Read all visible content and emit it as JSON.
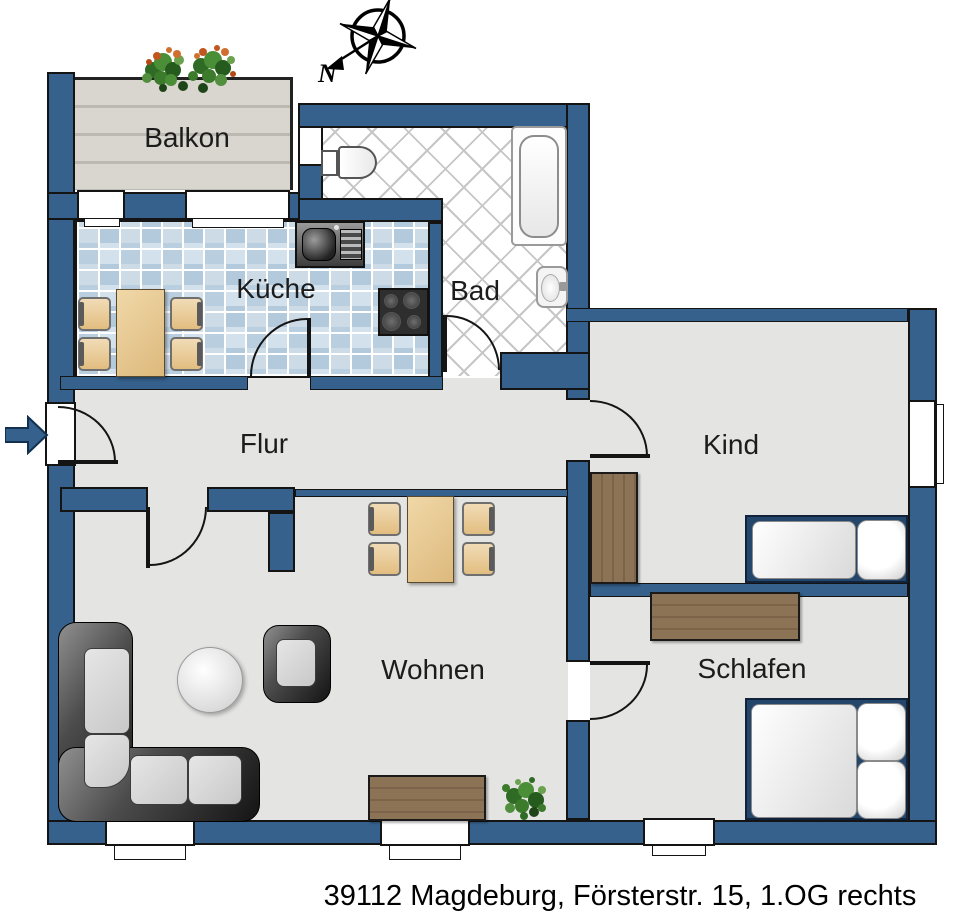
{
  "caption": "39112 Magdeburg, Försterstr. 15,  1.OG rechts",
  "compass": {
    "north_label": "N"
  },
  "rooms": {
    "balkon": "Balkon",
    "kueche": "Küche",
    "bad": "Bad",
    "flur": "Flur",
    "kind": "Kind",
    "wohnen": "Wohnen",
    "schlafen": "Schlafen"
  },
  "colors": {
    "wall": "#35618c",
    "floor": "#e4e4e2",
    "kitchen_tile_light": "#d3e1ec",
    "kitchen_tile_dark": "#b3cadc",
    "bath_tile": "#ffffff",
    "balcony_wood": "#d9d5cf",
    "cabinet_wood": "#8d7355",
    "table_wood": "#e8c98f",
    "bed_frame": "#24466b",
    "sofa_leather": "#2e2e2e",
    "plant_green": "#3c7a2c"
  },
  "icons": {
    "compass": "compass-rose",
    "entrance": "entrance-arrow"
  },
  "furniture": [
    "dining-table",
    "chair",
    "kitchen-sink",
    "stove",
    "toilet",
    "bathtub",
    "washbasin",
    "wardrobe",
    "single-bed",
    "double-bed",
    "corner-sofa",
    "armchair",
    "round-coffee-table",
    "sideboard",
    "plant"
  ]
}
